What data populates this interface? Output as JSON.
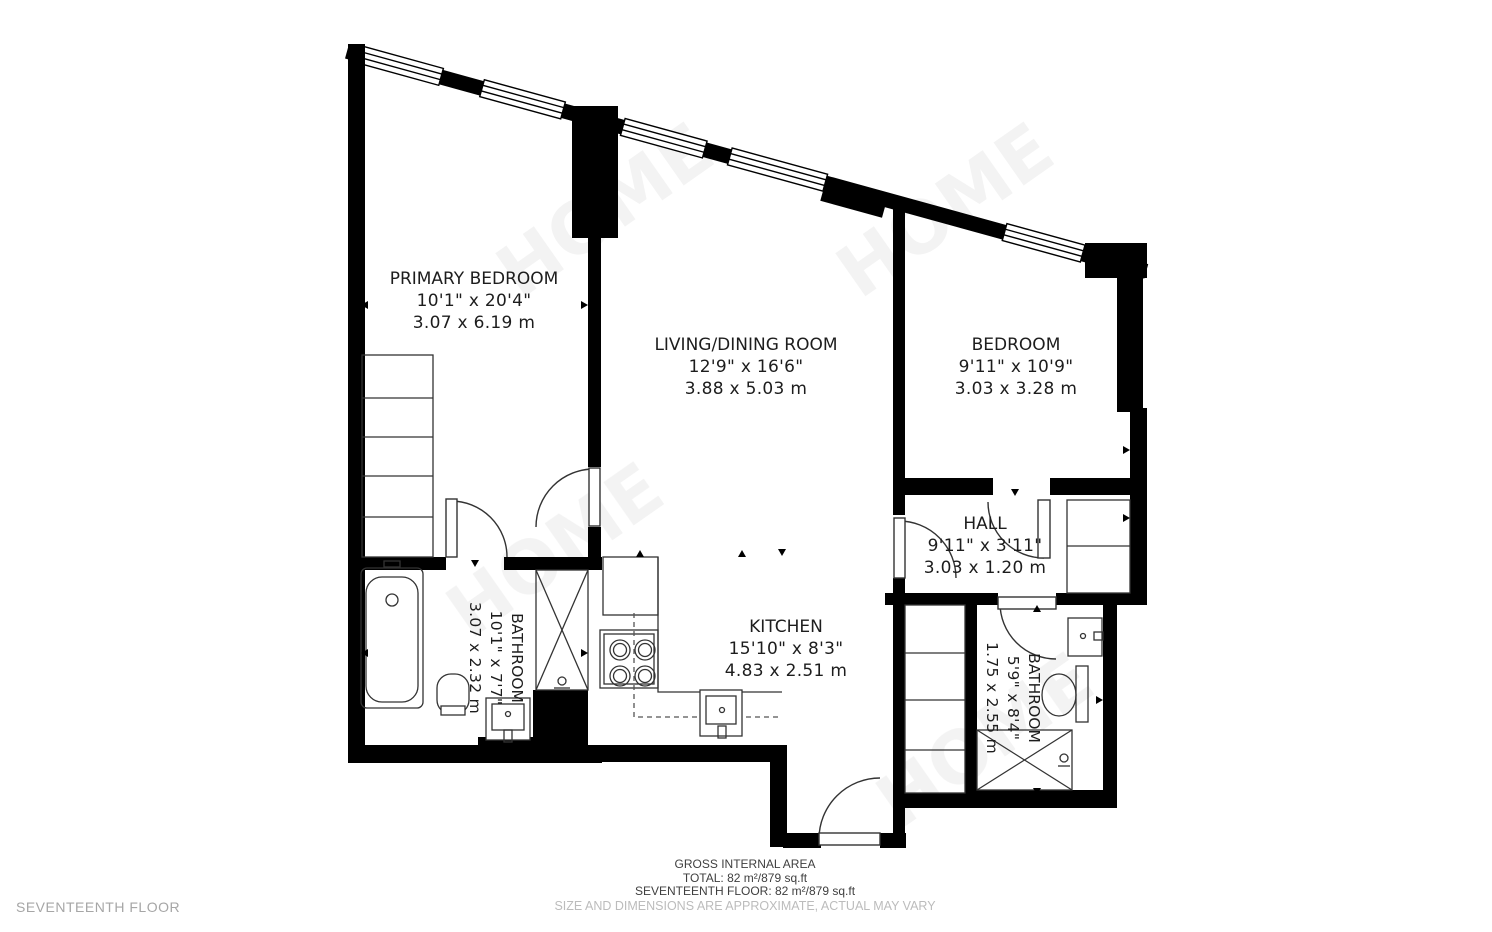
{
  "rooms": [
    {
      "name": "PRIMARY BEDROOM",
      "imperial": "10'1\" x 20'4\"",
      "metric": "3.07 x 6.19 m"
    },
    {
      "name": "LIVING/DINING ROOM",
      "imperial": "12'9\" x 16'6\"",
      "metric": "3.88 x 5.03 m"
    },
    {
      "name": "BEDROOM",
      "imperial": "9'11\" x 10'9\"",
      "metric": "3.03 x 3.28 m"
    },
    {
      "name": "HALL",
      "imperial": "9'11\" x 3'11\"",
      "metric": "3.03 x 1.20 m"
    },
    {
      "name": "KITCHEN",
      "imperial": "15'10\" x 8'3\"",
      "metric": "4.83 x 2.51 m"
    },
    {
      "name": "BATHROOM",
      "imperial": "10'1\" x 7'7\"",
      "metric": "3.07 x 2.32 m"
    },
    {
      "name": "BATHROOM",
      "imperial": "5'9\" x 8'4\"",
      "metric": "1.75 x 2.55 m"
    }
  ],
  "footer": {
    "area_title": "GROSS INTERNAL AREA",
    "total": "TOTAL: 82 m²/879 sq.ft",
    "floor_total": "SEVENTEENTH FLOOR: 82 m²/879 sq.ft",
    "disclaimer": "SIZE AND DIMENSIONS ARE APPROXIMATE, ACTUAL MAY VARY"
  },
  "floor_label": "SEVENTEENTH FLOOR",
  "watermark": {
    "text": "HOME"
  },
  "colors": {
    "wall": "#000000",
    "background": "#ffffff",
    "fixture_line": "#333333",
    "footer_text": "#3f3f3f",
    "muted_text": "#bcbcbc",
    "floor_label_text": "#a6a6a6"
  }
}
